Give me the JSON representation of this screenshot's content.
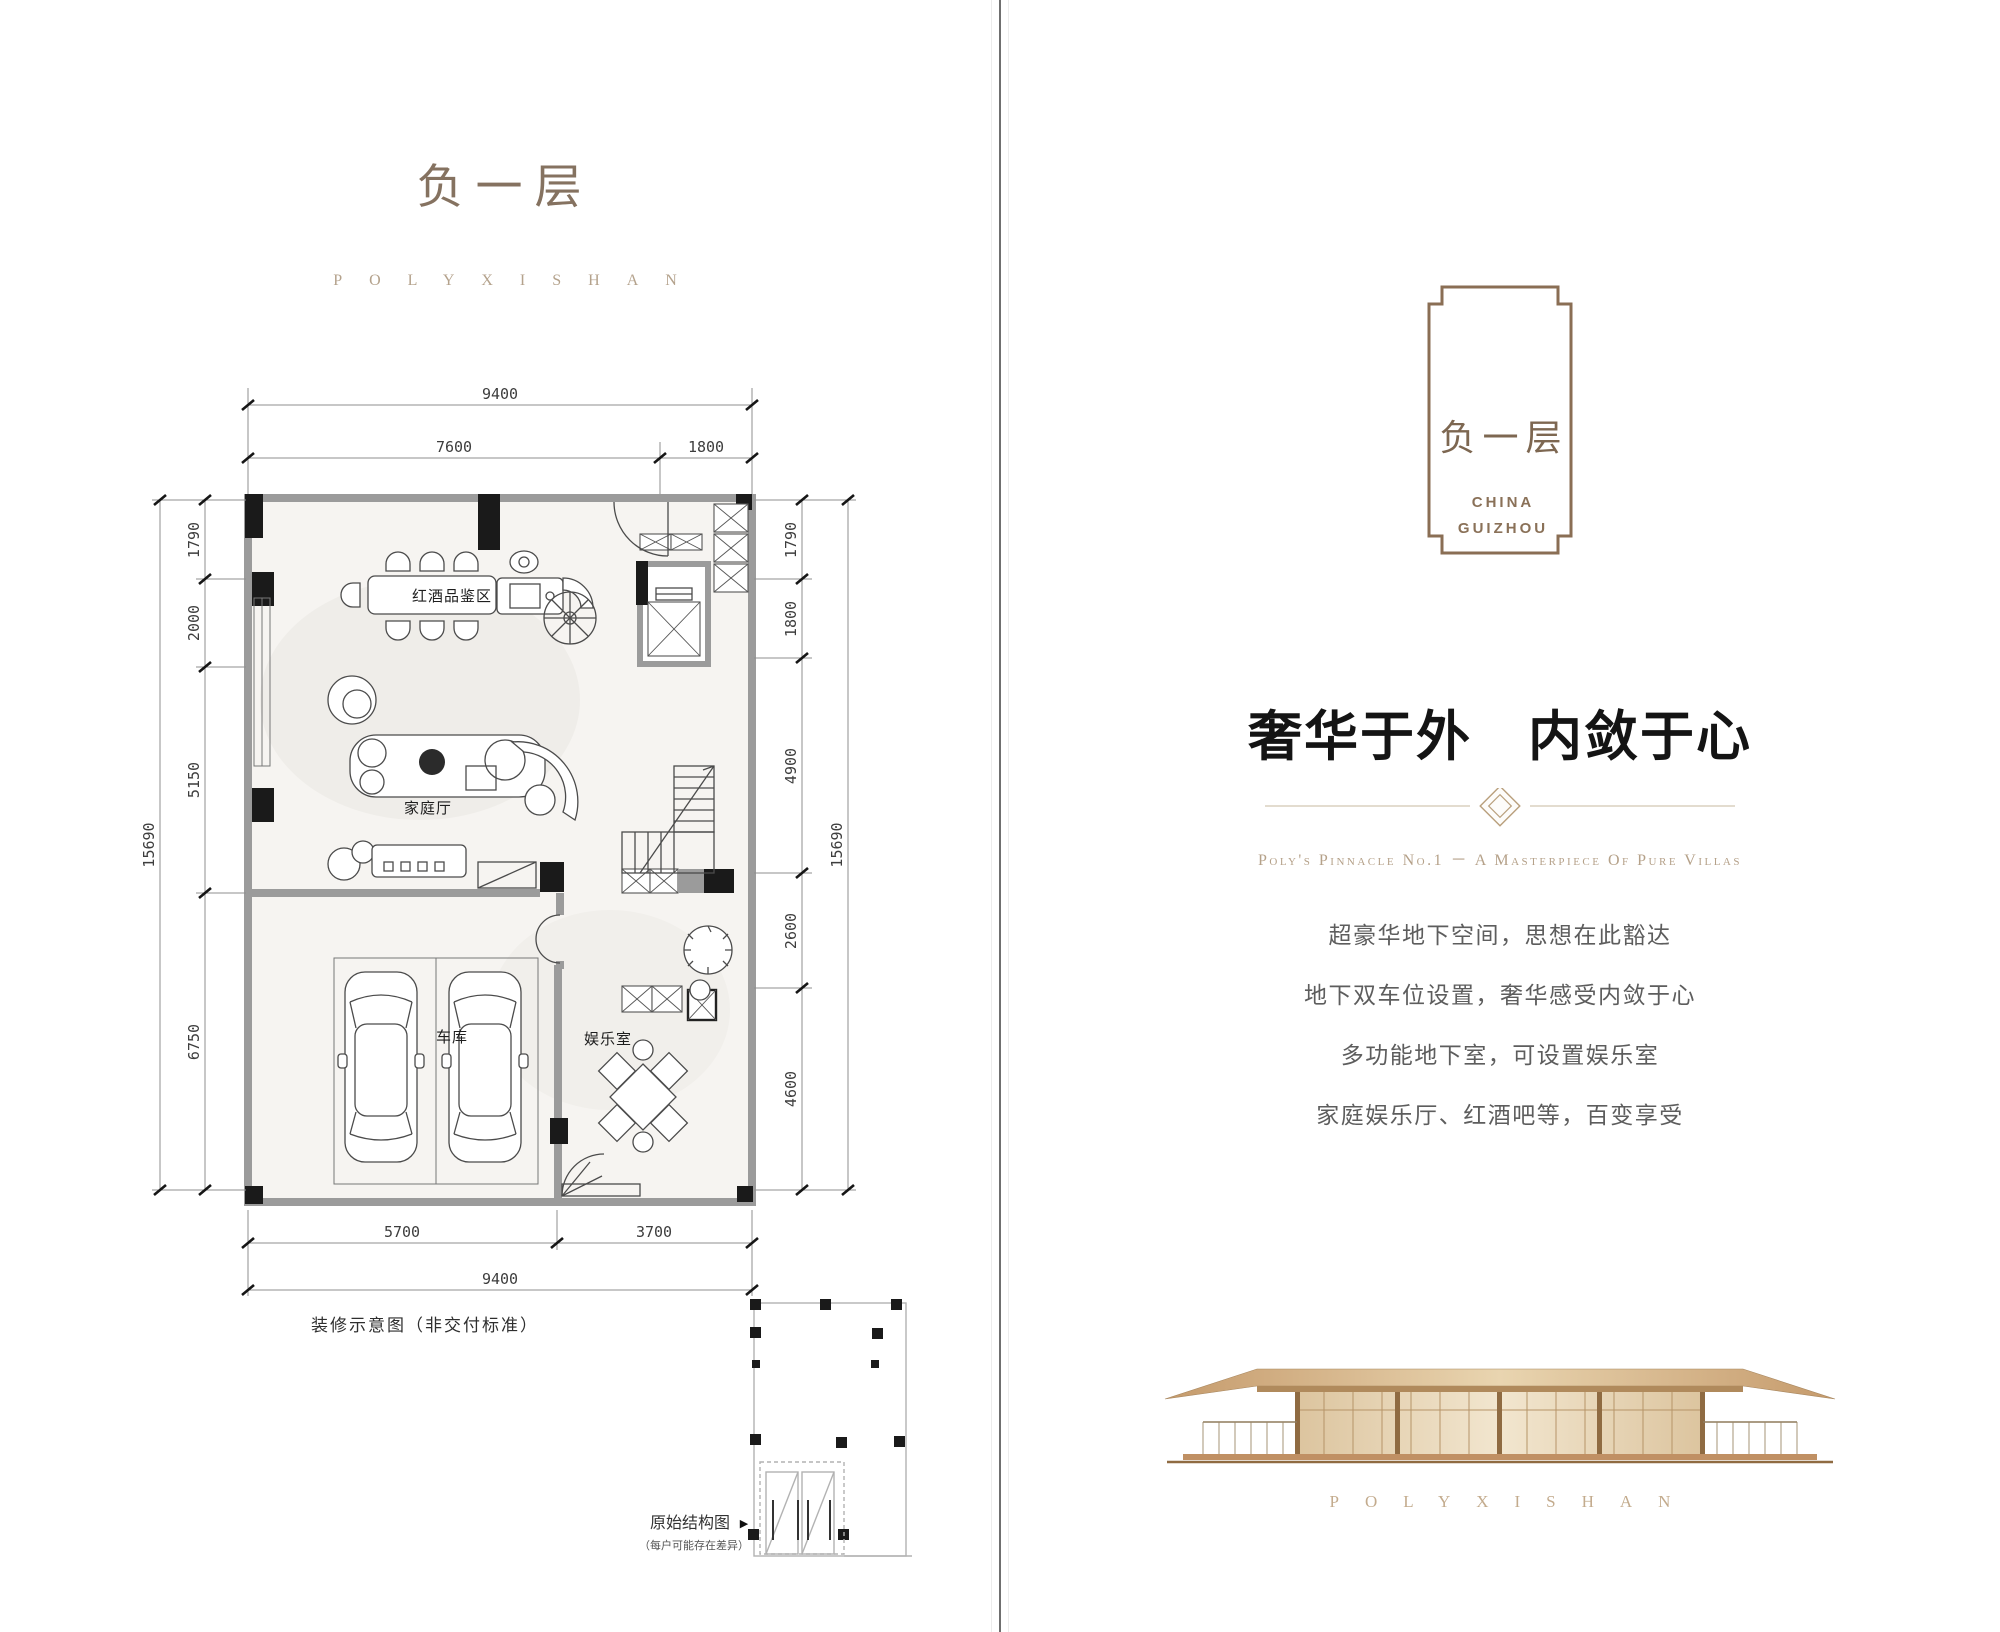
{
  "left_page": {
    "title": "负一层",
    "brand": "POLYXISHAN",
    "plan": {
      "rooms": {
        "wine_tasting": "红酒品鉴区",
        "family_hall": "家庭厅",
        "garage": "车库",
        "entertainment": "娱乐室"
      },
      "dimensions": {
        "top_total": "9400",
        "top_segments": [
          "7600",
          "1800"
        ],
        "left_total": "15690",
        "left_segments": [
          "1790",
          "2000",
          "5150",
          "6750"
        ],
        "right_total": "15690",
        "right_segments": [
          "1790",
          "1800",
          "4900",
          "2600",
          "4600"
        ],
        "bottom_segments": [
          "5700",
          "3700"
        ],
        "bottom_total": "9400"
      },
      "note": "装修示意图（非交付标准）",
      "structure_diagram": {
        "label": "原始结构图",
        "pointer": "▶",
        "sub_label": "（每户可能存在差异）"
      }
    }
  },
  "right_page": {
    "emblem": {
      "title": "负一层",
      "subtitle_line1": "CHINA",
      "subtitle_line2": "GUIZHOU"
    },
    "headline": "奢华于外　内敛于心",
    "tagline": "Poly's Pinnacle No.1 － A Masterpiece Of Pure Villas",
    "paragraphs": [
      "超豪华地下空间，思想在此豁达",
      "地下双车位设置，奢华感受内敛于心",
      "多功能地下室，可设置娱乐室",
      "家庭娱乐厅、红酒吧等，百变享受"
    ],
    "brand": "POLYXISHAN"
  },
  "colors": {
    "gold_frame": "#8a6e54",
    "tan_text": "#b4a28c",
    "wall_gray": "#9b9b9b",
    "heading_dark": "#141414",
    "body_gray": "#5d5d5d",
    "building_tan": "#c59a6b"
  }
}
